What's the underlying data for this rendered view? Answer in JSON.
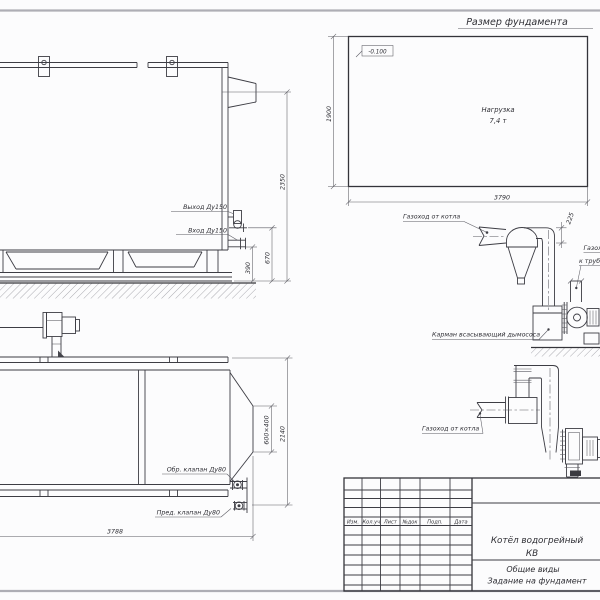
{
  "foundation_plan": {
    "title": "Размер фундамента",
    "elevation_mark": "-0.100",
    "load_line1": "Нагрузка",
    "load_line2": "7,4 т",
    "dim_depth": "1900",
    "dim_width": "3790"
  },
  "boiler_side_view": {
    "label_outlet": "Выход Ду150",
    "label_inlet": "Вход Ду150",
    "dim_total_height": "2350",
    "dim_inlet_height": "670",
    "dim_frame_height": "390"
  },
  "boiler_top_view": {
    "label_check_valve": "Обр. клапан Ду80",
    "label_safety_valve": "Пред. клапан Ду80",
    "dim_flue_opening": "600×400",
    "dim_width": "2140",
    "dim_length": "3788"
  },
  "flue_duct_upper": {
    "label_from_boiler": "Газоход от котла",
    "label_to_stack_line1": "Газоход",
    "label_to_stack_line2": "к трубе",
    "label_pocket": "Карман всасывающий дымососа",
    "dim_offset": "225"
  },
  "flue_duct_lower": {
    "label_from_boiler": "Газоход от котла"
  },
  "title_block": {
    "columns": [
      "Изм.",
      "Кол.уч",
      "Лист",
      "№док",
      "Подп.",
      "Дата"
    ],
    "product_line1": "Котёл водогрейный",
    "product_line2": "КВ",
    "doc_line1": "Общие виды",
    "doc_line2": "Задание на фундамент"
  }
}
